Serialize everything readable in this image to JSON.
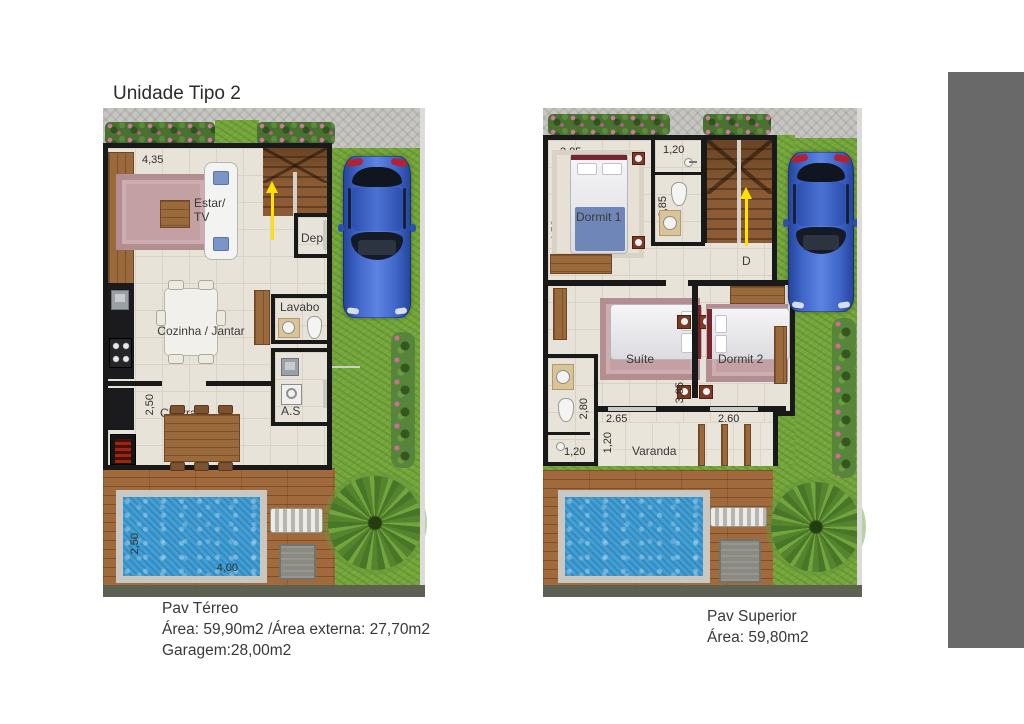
{
  "title": "Unidade Tipo 2",
  "palette": {
    "grass": "#74a53c",
    "paving": "#c6c5c1",
    "pool_water": "#419fd3",
    "deck": "#a06a3c",
    "wall": "#191919",
    "stair_arrow": "#ffe100",
    "car": "#3f66c9",
    "sidebar": "#696969"
  },
  "ground_floor": {
    "labels": {
      "estar1": "Estar/",
      "estar2": "TV",
      "dep": "Dep",
      "cozinha": "Cozinha / Jantar",
      "lavabo": "Lavabo",
      "as": "A.S",
      "churrasq": "Churrasq"
    },
    "dims": {
      "estar_w": "4,35",
      "estar_h": "6,60",
      "churrasq_h": "2,50",
      "pool_h": "2,50",
      "pool_w": "4,00"
    },
    "caption": {
      "l1": "Pav Térreo",
      "l2": "Área: 59,90m2 /Área externa: 27,70m2",
      "l3": "Garagem:28,00m2"
    }
  },
  "upper_floor": {
    "labels": {
      "dormit1": "Dormit 1",
      "suite": "Suíte",
      "dormit2": "Dormit 2",
      "varanda": "Varanda",
      "stair_dir": "D"
    },
    "dims": {
      "d1_w": "2,85",
      "d1_h": "4,50",
      "bath_w": "1,20",
      "bath_h": "2,85",
      "suite_w": "2,65",
      "suite_h": "3,85",
      "d2_w": "2,60",
      "sbath_h": "2,80",
      "sbath_w": "1,20",
      "varanda_d": "1,20"
    },
    "caption": {
      "l1": "Pav Superior",
      "l2": "Área: 59,80m2"
    }
  }
}
